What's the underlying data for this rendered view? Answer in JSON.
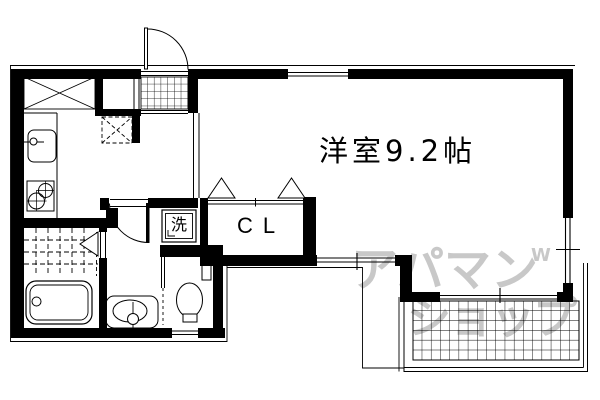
{
  "plan": {
    "background": "#ffffff",
    "line_color": "#000000",
    "watermark_color": "#c8c8c8",
    "labels": {
      "main_room": "洋室9.2帖",
      "closet": "CL",
      "washing_machine": "洗"
    },
    "watermark": {
      "line1": "アパマン",
      "line2": "ショップ",
      "mark": "W"
    },
    "icons": {
      "entrance_door": "door-swing-arc",
      "interior_door": "door-swing-arc",
      "shoe_cabinet": "crossed-box",
      "refrigerator": "dashed-crossed-box",
      "kitchen_sink": "basin-with-faucet",
      "stove": "two-burner-rings",
      "bathtub": "rounded-tub",
      "bath_floor": "dashed-tile-grid",
      "bath_door": "folding-door-triangle",
      "washbasin": "oval-basin",
      "toilet": "bowl-with-tank",
      "closet_doors": "folding-door-triangles",
      "entrance_floor": "tile-grid",
      "balcony_floor": "hatch-grid",
      "windows": "double-line-glazing"
    }
  }
}
